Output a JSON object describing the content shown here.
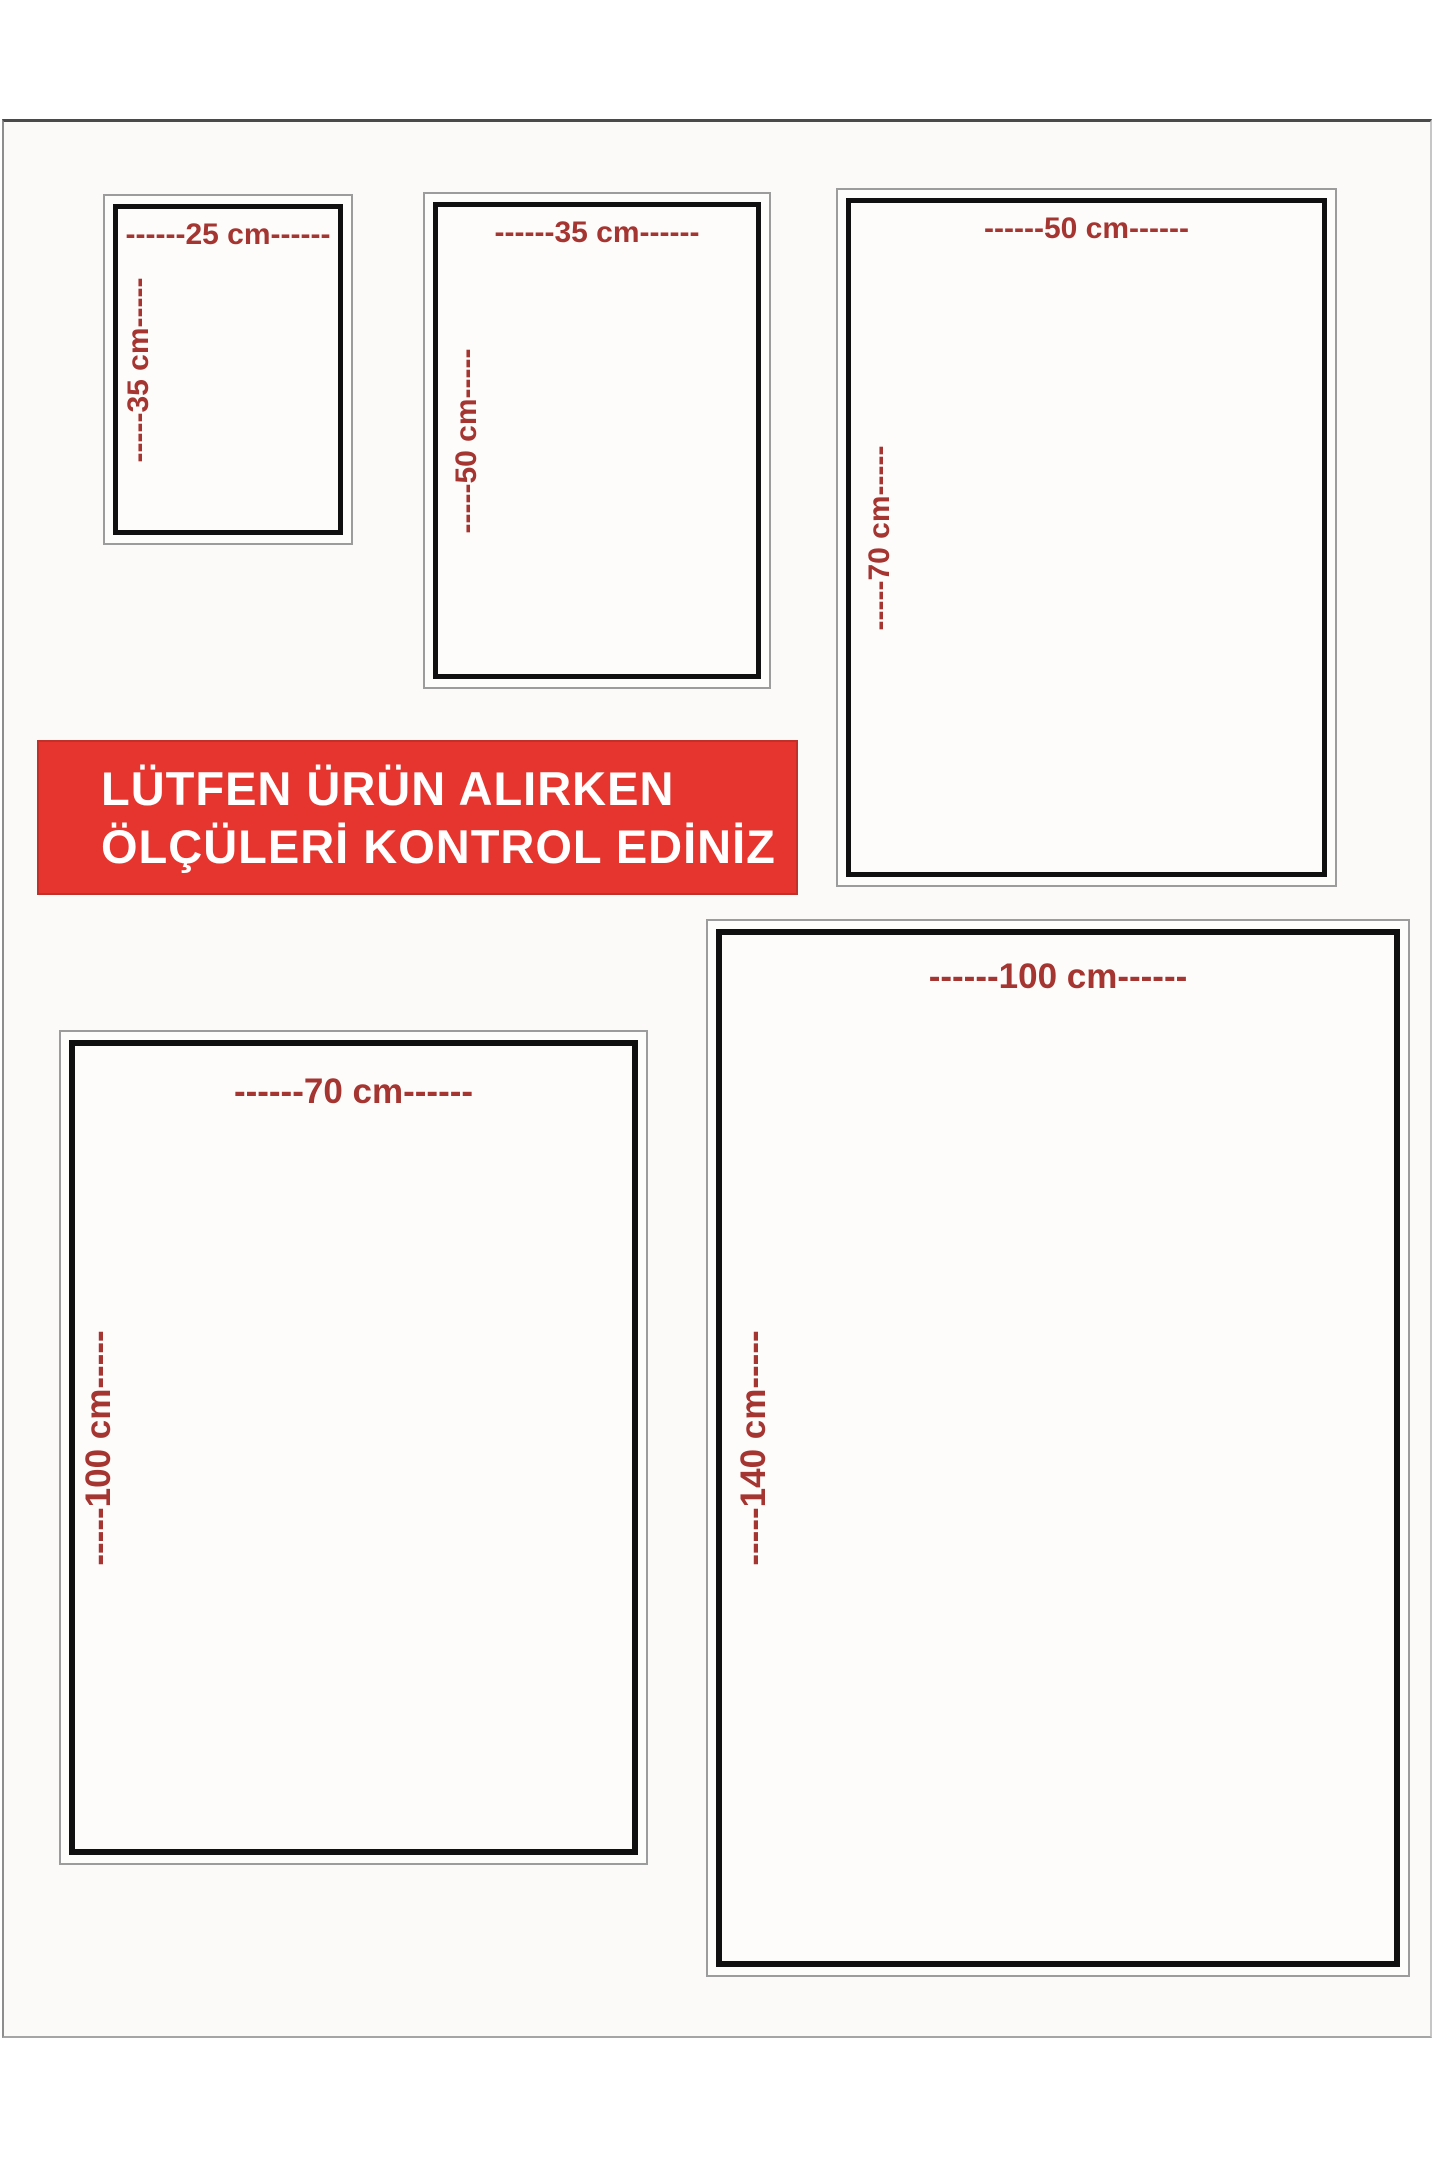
{
  "banner": {
    "line1": "LÜTFEN ÜRÜN ALIRKEN",
    "line2": "ÖLÇÜLERİ KONTROL EDİNİZ",
    "background_color": "#e6352f",
    "text_color": "#ffffff"
  },
  "colors": {
    "dimension_red": "#a53531",
    "frame_black": "#101010",
    "outer_frame_gray": "#9c9c9c",
    "page_background": "#fbfaf8"
  },
  "sizes": [
    {
      "width_cm": 25,
      "height_cm": 35,
      "width_label": "------25 cm------",
      "height_label": "-----35 cm-----"
    },
    {
      "width_cm": 35,
      "height_cm": 50,
      "width_label": "------35 cm------",
      "height_label": "-----50 cm-----"
    },
    {
      "width_cm": 50,
      "height_cm": 70,
      "width_label": "------50 cm------",
      "height_label": "-----70 cm-----"
    },
    {
      "width_cm": 70,
      "height_cm": 100,
      "width_label": "------70 cm------",
      "height_label": "-----100 cm-----"
    },
    {
      "width_cm": 100,
      "height_cm": 140,
      "width_label": "------100 cm------",
      "height_label": "-----140 cm-----"
    }
  ]
}
